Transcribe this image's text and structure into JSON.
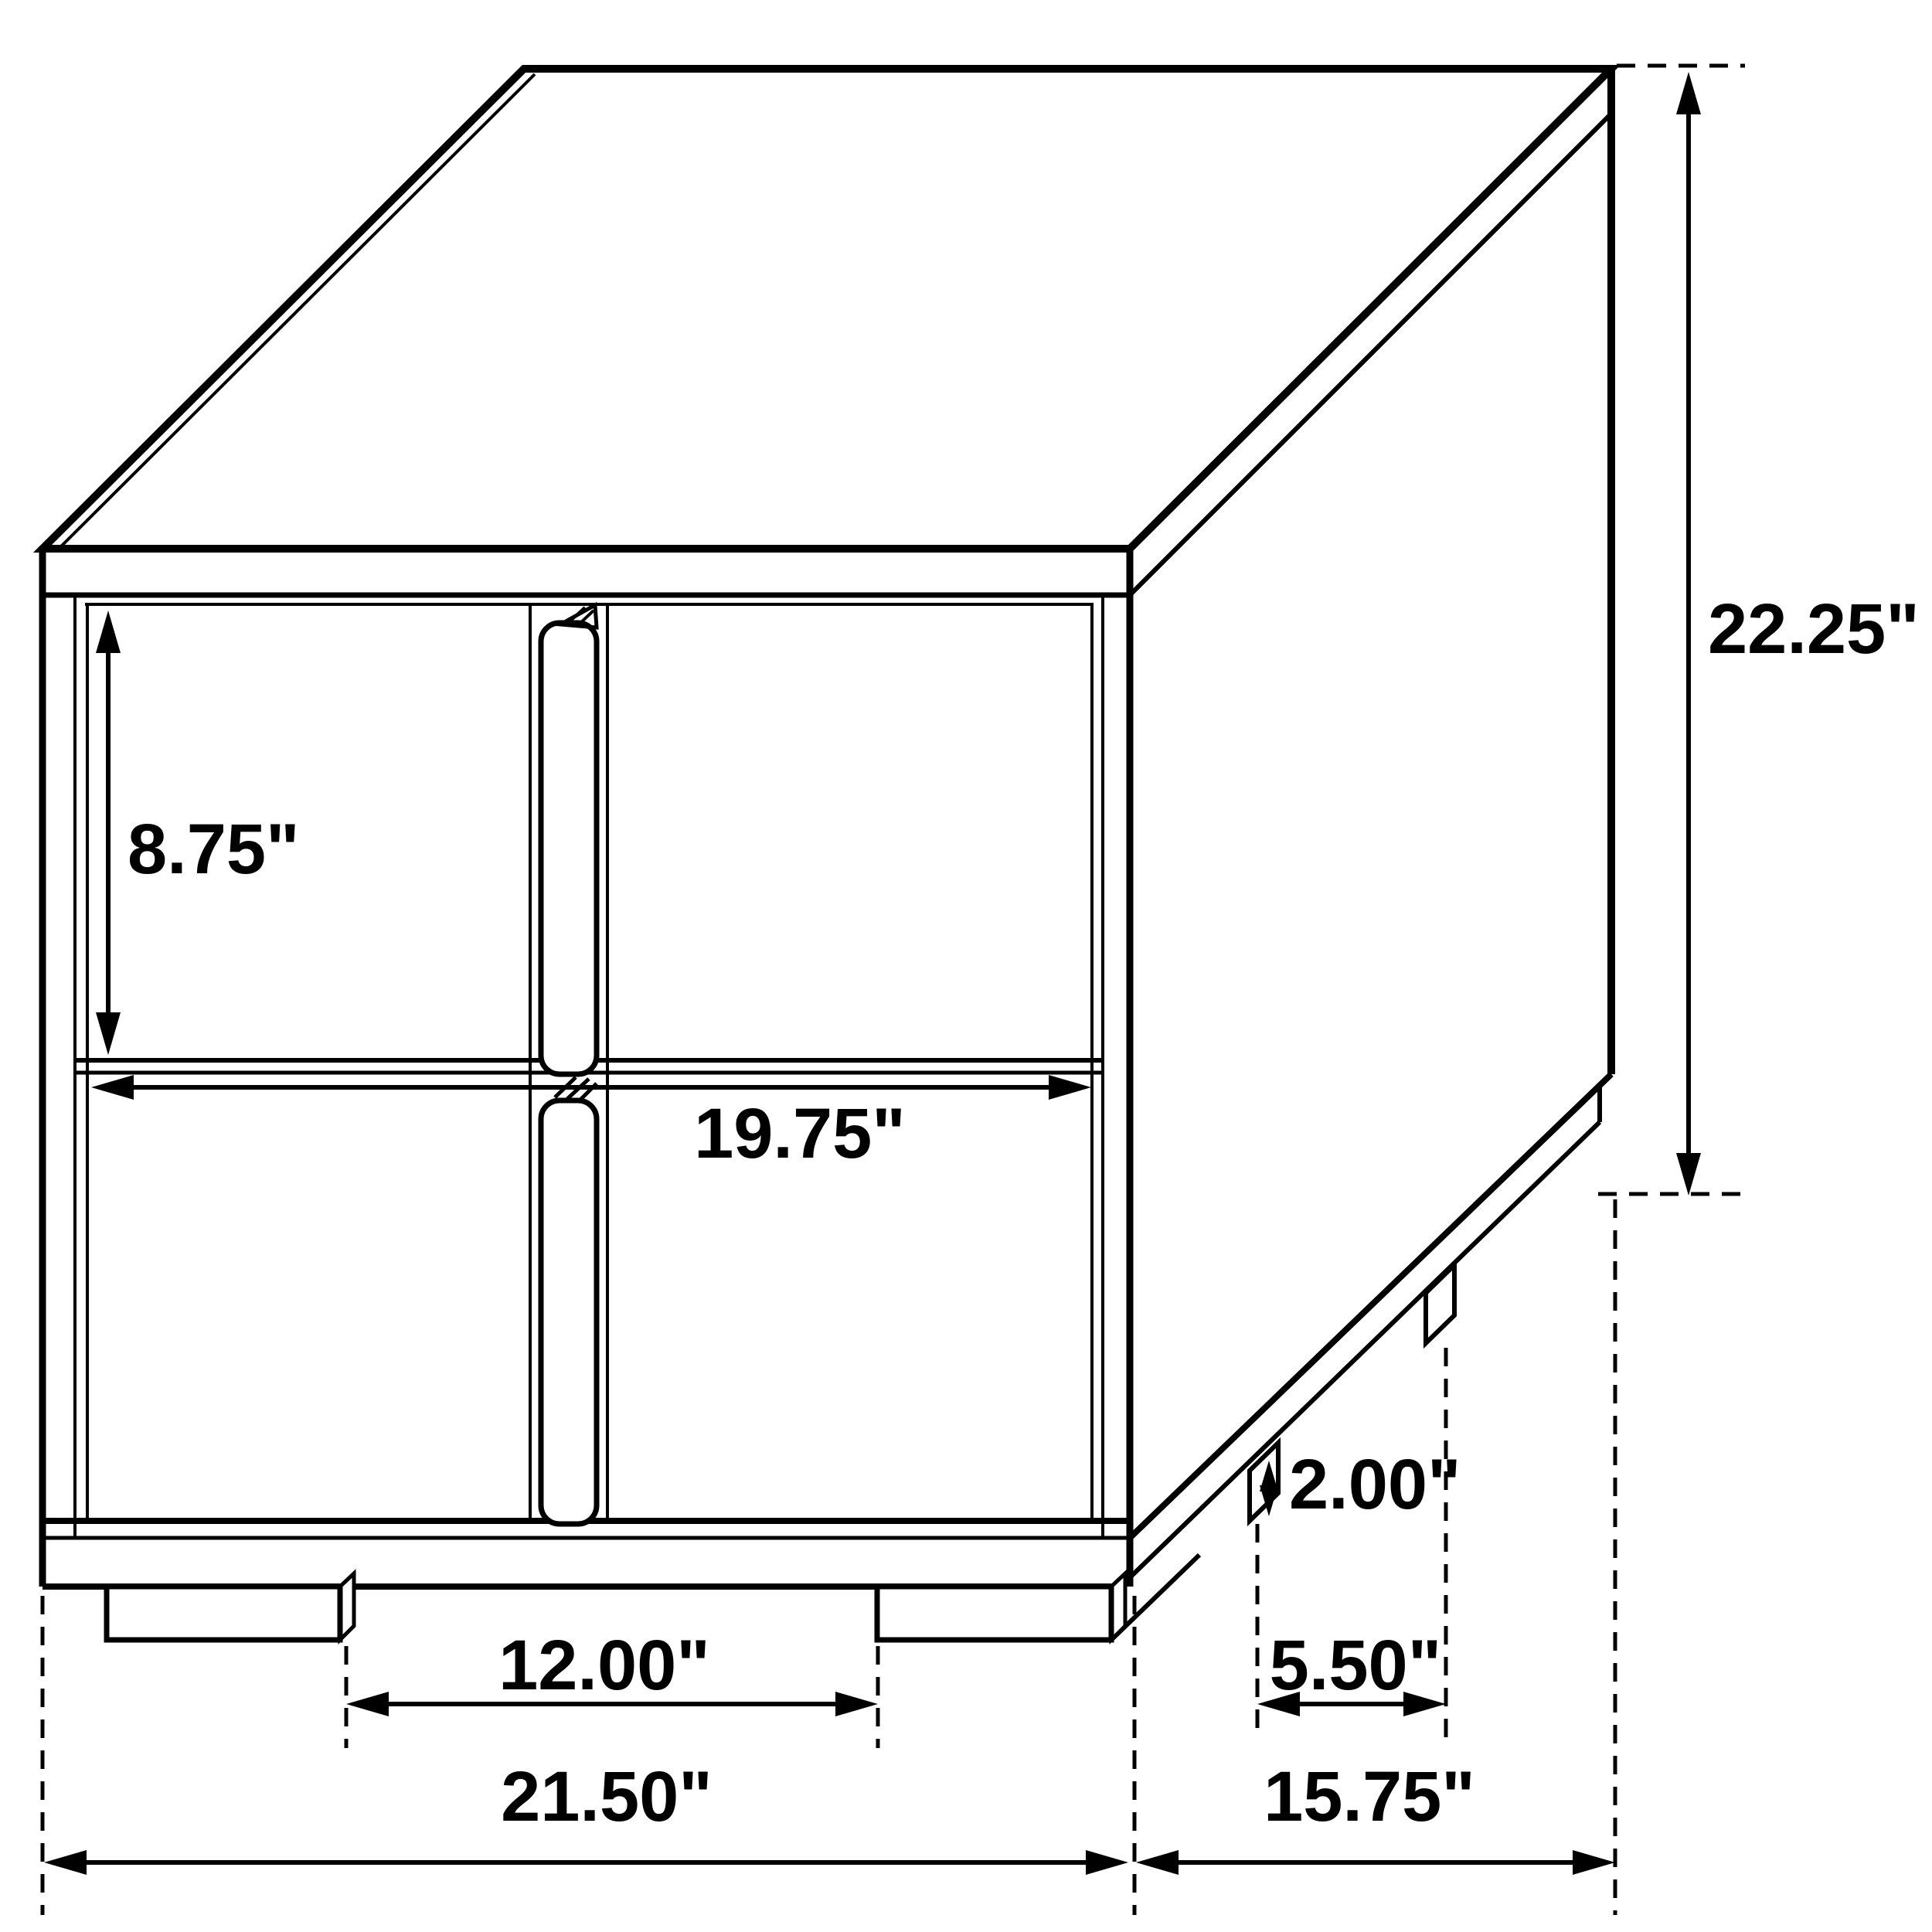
{
  "drawing": {
    "kind": "isometric-dimension-drawing",
    "subject": "two-drawer nightstand side table",
    "line_color": "#000000",
    "background_color": "#ffffff",
    "dimensions": {
      "drawer_height": "8.75\"",
      "drawer_opening_width": "19.75\"",
      "overall_height": "22.25\"",
      "base_height": "2.00\"",
      "side_leg_spacing": "5.50\"",
      "front_leg_spacing": "12.00\"",
      "overall_width": "21.50\"",
      "overall_depth": "15.75\""
    }
  }
}
